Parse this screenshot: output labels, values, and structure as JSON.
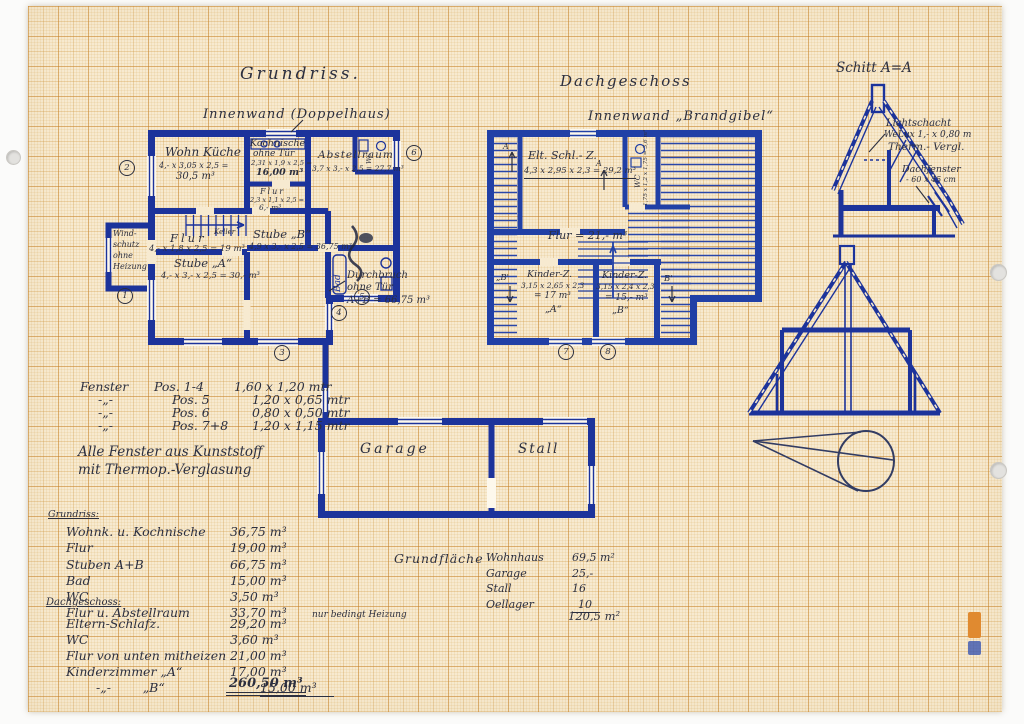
{
  "titles": {
    "grundriss": "Grundriss.",
    "innenwand_left": "Innenwand (Doppelhaus)",
    "dachgeschoss": "Dachgeschoss",
    "innenwand_right": "Innenwand „Brandgibel“",
    "schnitt": "Schitt A=A"
  },
  "grundriss_rooms": {
    "wohnkueche": {
      "name": "Wohn Küche",
      "dims": "4,- x 3,05 x 2,5 =",
      "vol": "30,5 m³"
    },
    "kochnische": {
      "name": "Kochnische",
      "name2": "ohne Tür",
      "dims": "2,31 x 1,9 x 2,5 =",
      "vol": "16,00 m³"
    },
    "flur_klein": {
      "name": "Flur",
      "dims": "2,3 x 1,1 x 2,5 =",
      "vol": "6,- m³"
    },
    "abstellraum": {
      "name": "Abstellraum",
      "dims": "3,7 x 3,- x 2,5 = 27,7 m³"
    },
    "wc": {
      "name": "WC"
    },
    "windschutz": {
      "l1": "Wind-",
      "l2": "schutz",
      "l3": "ohne",
      "l4": "Heizung"
    },
    "flur": {
      "name": "Flur",
      "dims": "4,- x 1,8 x 2,5 = 19 m³",
      "keller": "Keller"
    },
    "stube_b": {
      "name": "Stube „B“",
      "dims": "4,9 x 3,- x 2,5 = 36,75 m³"
    },
    "stube_a": {
      "name": "Stube „A“",
      "dims": "4,- x 3,- x 2,5 = 30,- m³"
    },
    "durchbruch": {
      "l1": "Durchbruch",
      "l2": "ohne Tür",
      "l3": "A+B = 66,75 m³"
    },
    "bad": {
      "name": "Bad"
    }
  },
  "dach_rooms": {
    "elt_schlafz": {
      "name": "Elt. Schl.- Z.",
      "dims": "4,3 x 2,95 x 2,3 = 29,2 m³"
    },
    "wc": {
      "name": "WC",
      "dims": "1,75 x 1,2 x 1,75 = 3,6 m³"
    },
    "flur": {
      "text": "Flur = 21,- m³"
    },
    "kinder_a": {
      "name": "Kinder-Z.",
      "dims": "3,15 x 2,65 x 2,3",
      "vol": "= 17 m³",
      "tag": "„A“"
    },
    "kinder_b": {
      "name": "Kinder-Z.",
      "dims": "3,15 x 2,4 x 2,3",
      "vol": "= 15,- m³",
      "tag": "„B“"
    },
    "sec_a1": "A",
    "sec_a2": "A",
    "sec_b1": "„B'",
    "sec_b2": "B'"
  },
  "outbuildings": {
    "garage": "Garage",
    "stall": "Stall"
  },
  "section_notes": {
    "licht_l1": "Lichtschacht",
    "licht_l2": "WeLux 1,- x 0,80 m",
    "licht_l3": "Therm.- Vergl.",
    "dachfenster_l1": "Dachfenster",
    "dachfenster_l2": "- 60 x 45 cm"
  },
  "markers": {
    "m1": "1",
    "m2": "2",
    "m3": "3",
    "m4": "4",
    "m5": "5",
    "m6": "6",
    "m7": "7",
    "m8": "8"
  },
  "fenster": {
    "rows": [
      {
        "l": "Fenster",
        "p": "Pos. 1-4",
        "s": "1,60 x 1,20 mtr"
      },
      {
        "l": "-„-",
        "p": "Pos.   5",
        "s": "1,20 x 0,65 mtr"
      },
      {
        "l": "-„-",
        "p": "Pos.   6",
        "s": "0,80 x 0,50 mtr"
      },
      {
        "l": "-„-",
        "p": "Pos. 7+8",
        "s": "1,20 x 1,15 mtr"
      }
    ],
    "note1": "Alle Fenster aus Kunststoff",
    "note2": "mit Thermop.-Verglasung"
  },
  "volumes": {
    "grundriss_header": "Grundriss:",
    "grundriss_rows": [
      {
        "label": "Wohnk. u. Kochnische",
        "value": "36,75 m³",
        "note": ""
      },
      {
        "label": "Flur",
        "value": "19,00 m³",
        "note": ""
      },
      {
        "label": "Stuben A+B",
        "value": "66,75 m³",
        "note": ""
      },
      {
        "label": "Bad",
        "value": "15,00 m³",
        "note": ""
      },
      {
        "label": "WC",
        "value": "3,50 m³",
        "note": ""
      },
      {
        "label": "Flur u. Abstellraum",
        "value": "33,70 m³",
        "note": "nur bedingt Heizung"
      }
    ],
    "dach_header": "Dachgeschoss:",
    "dach_rows": [
      {
        "label": "Eltern-Schlafz.",
        "value": "29,20 m³"
      },
      {
        "label": "WC",
        "value": "3,60 m³"
      },
      {
        "label": "Flur von unten mitheizen",
        "value": "21,00 m³"
      },
      {
        "label": "Kinderzimmer „A“",
        "value": "17,00 m³"
      },
      {
        "label": "-„-        „B“",
        "value": "15,00 m³"
      }
    ],
    "dach_total": "260,50 m³"
  },
  "flaechen": {
    "header": "Grundfläche",
    "rows": [
      {
        "label": "Wohnhaus",
        "value": "69,5 m²"
      },
      {
        "label": "Garage",
        "value": "25,-"
      },
      {
        "label": "Stall",
        "value": "16"
      },
      {
        "label": "Oellager",
        "value": "10"
      }
    ],
    "total": "120,5 m²"
  },
  "ink": {
    "blue": "#1c339b",
    "hand": "#2c2f3f",
    "paper": "#f7ead0"
  }
}
